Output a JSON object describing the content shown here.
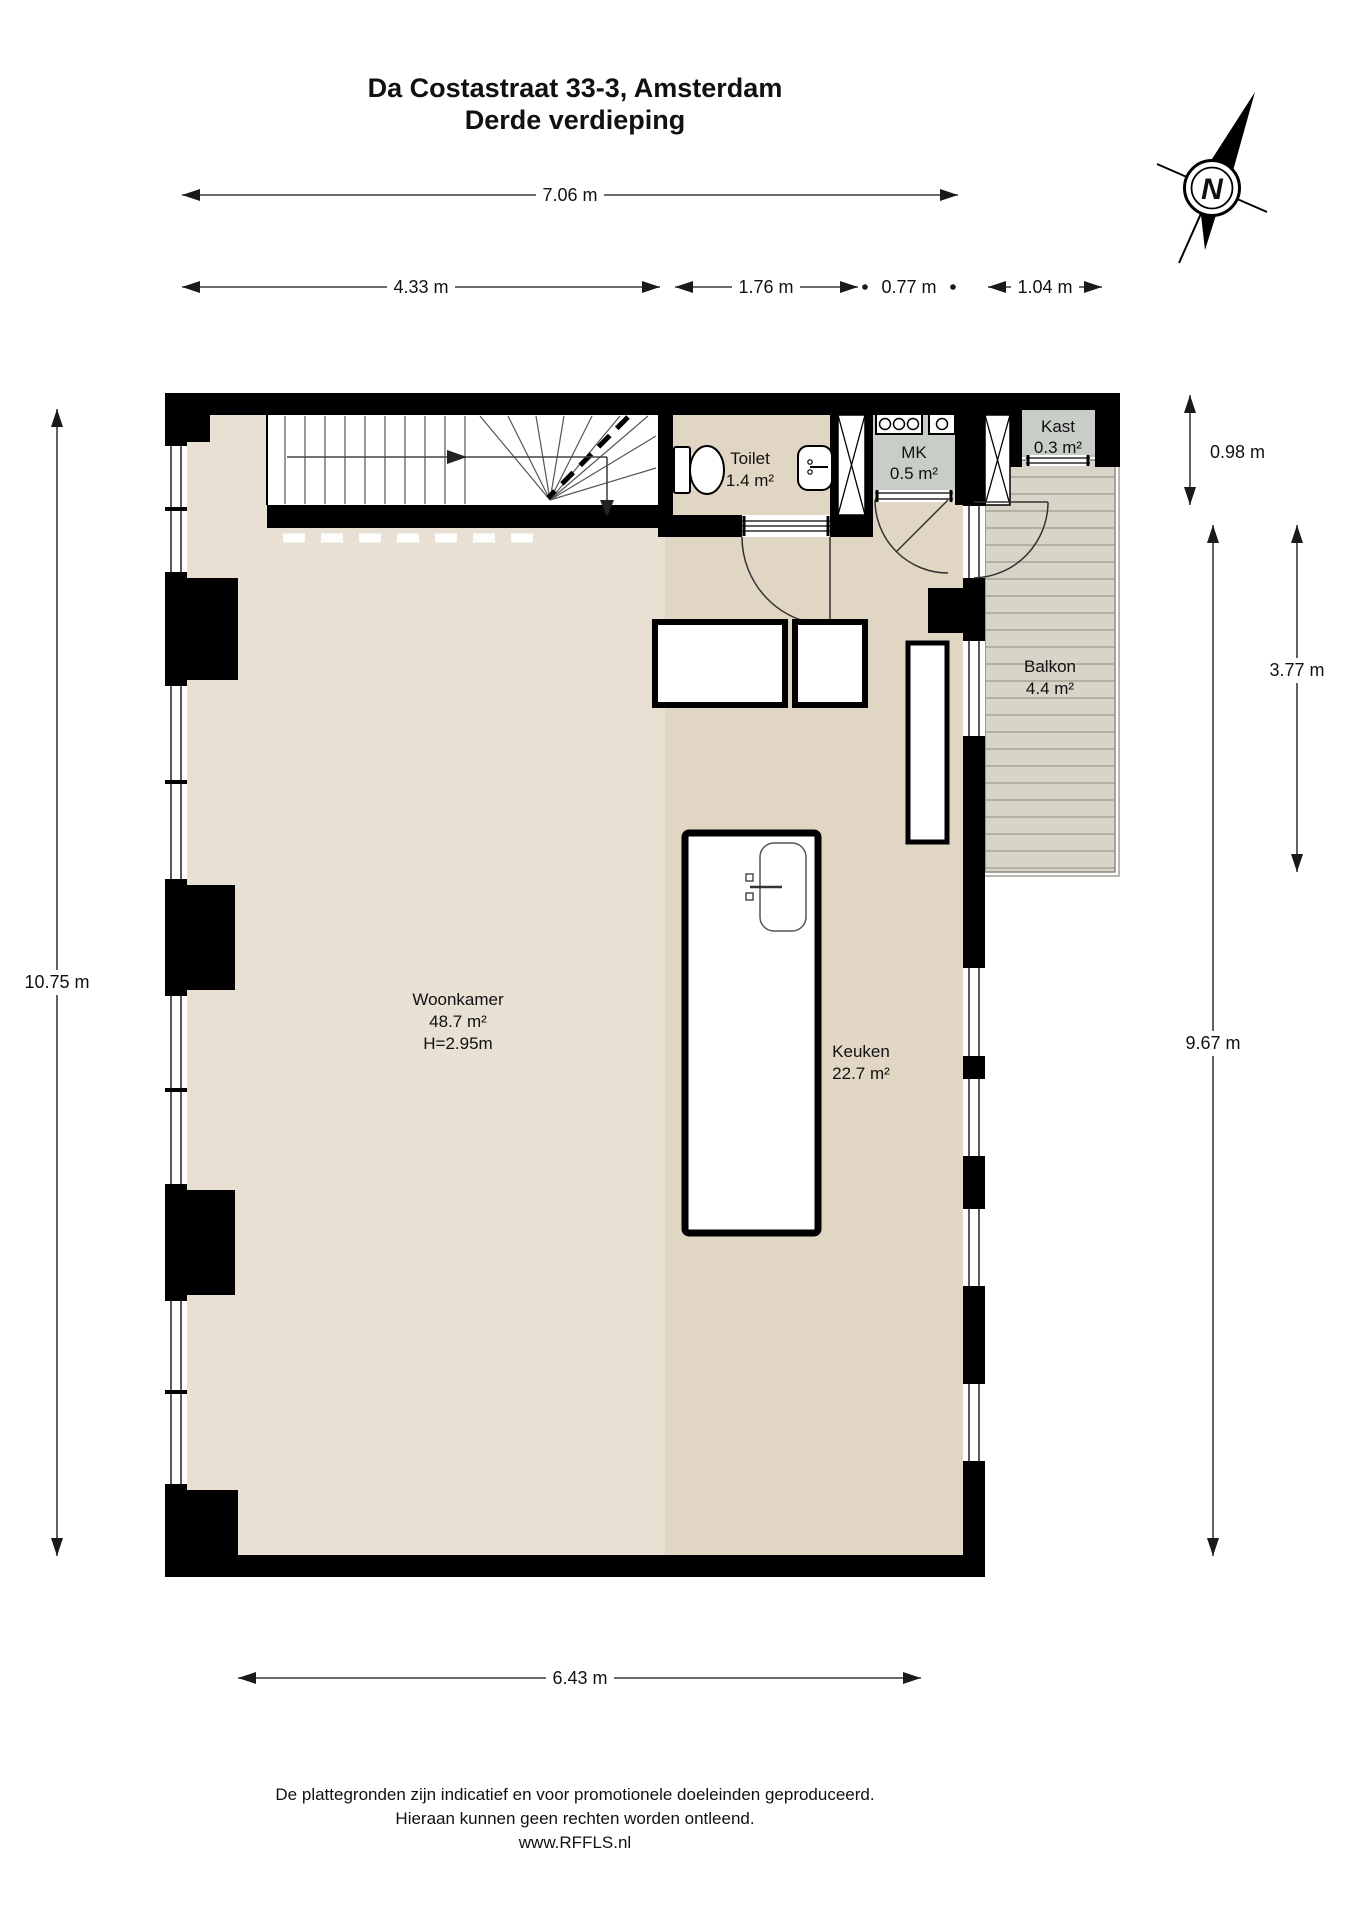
{
  "title": {
    "line1": "Da Costastraat 33-3, Amsterdam",
    "line2": "Derde verdieping"
  },
  "compass": {
    "north_letter": "N"
  },
  "dimensions": {
    "top_total": "7.06 m",
    "top_segments": [
      "4.33 m",
      "1.76 m",
      "0.77 m",
      "1.04 m"
    ],
    "right_top": "0.98 m",
    "right_balcony": "3.77 m",
    "right_total": "9.67 m",
    "left_total": "10.75 m",
    "bottom_total": "6.43 m"
  },
  "rooms": {
    "woonkamer": {
      "name": "Woonkamer",
      "area": "48.7 m²",
      "ceiling": "H=2.95m"
    },
    "keuken": {
      "name": "Keuken",
      "area": "22.7 m²"
    },
    "toilet": {
      "name": "Toilet",
      "area": "1.4 m²"
    },
    "mk": {
      "name": "MK",
      "area": "0.5 m²"
    },
    "kast": {
      "name": "Kast",
      "area": "0.3 m²"
    },
    "balkon": {
      "name": "Balkon",
      "area": "4.4 m²"
    }
  },
  "footer": {
    "line1": "De plattegronden zijn indicatief en voor promotionele doeleinden geproduceerd.",
    "line2": "Hieraan kunnen geen rechten worden ontleend.",
    "line3": "www.RFFLS.nl"
  },
  "colors": {
    "wall": "#000000",
    "floor_light": "#e7e0d3",
    "floor_dark": "#e0d6c3",
    "closet_floor": "#c9cdc8",
    "balcony_floor": "#d8d5c8",
    "balcony_plank_line": "#b3b0a2"
  }
}
